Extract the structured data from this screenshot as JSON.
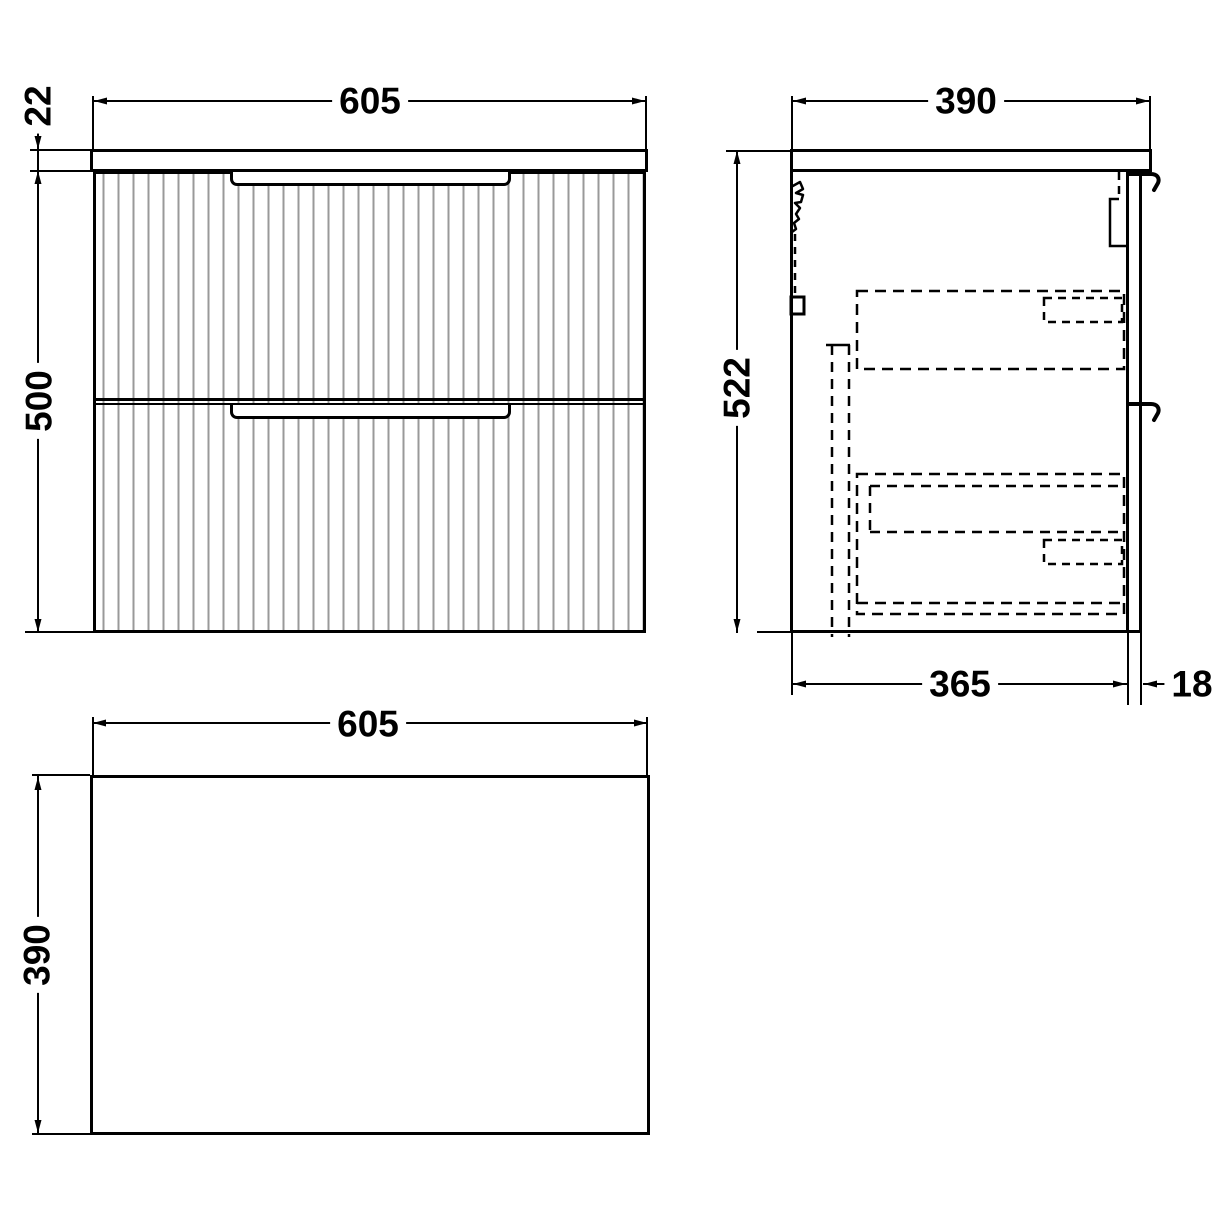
{
  "drawing": {
    "type": "furniture technical drawing, three orthographic views of a two-drawer fluted wall-hung vanity unit",
    "views": {
      "front": {
        "label": "front-elevation",
        "dimensions": {
          "width": "605",
          "worktop_thickness": "22",
          "body_height": "500"
        }
      },
      "side": {
        "label": "side-section",
        "dimensions": {
          "depth": "390",
          "overall_height": "522",
          "body_depth": "365",
          "front_panel_thickness": "18"
        }
      },
      "plan": {
        "label": "plan-view",
        "dimensions": {
          "width": "605",
          "depth": "390"
        }
      }
    }
  },
  "dimensions": {
    "front_width": "605",
    "front_worktop_thickness": "22",
    "front_height": "500",
    "side_depth": "390",
    "side_height": "522",
    "side_body_depth": "365",
    "side_panel_thickness": "18",
    "plan_width": "605",
    "plan_depth": "390"
  },
  "colors": {
    "line": "#000000",
    "flute": "#999999",
    "background": "#ffffff"
  }
}
